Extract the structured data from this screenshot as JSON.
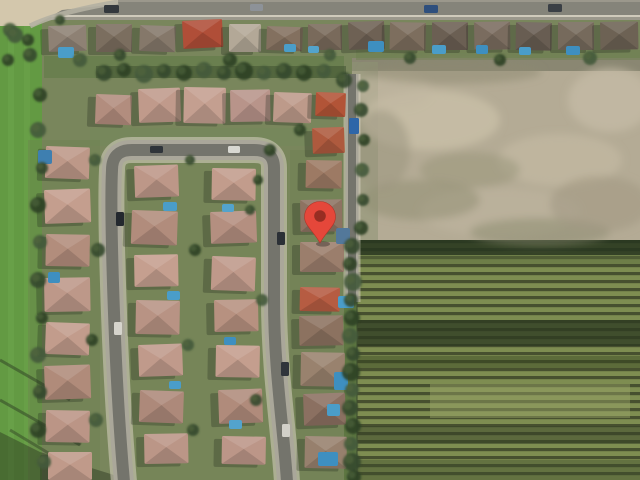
{
  "map": {
    "kind": "satellite-aerial-view",
    "width": 640,
    "height": 480,
    "marker": {
      "name": "location-pin",
      "x": 320,
      "y": 217,
      "tip_y": 243,
      "radius": 15.5,
      "color": "#e5473a",
      "inner_color": "#8e2a20",
      "inner_radius": 5.8
    },
    "palette": {
      "base": "#79865c",
      "field": "#639a43",
      "field_stripe": "#74ac52",
      "dirt": "#b4ab95",
      "crop_light": "#7e8d51",
      "crop_dark": "#47502f",
      "road_casing": "#aaa79a",
      "road_core": "#74746c",
      "sidewalk": "#d8d2c2",
      "pool": "#4a9dc9",
      "tree_colors": [
        "#34492c",
        "#2c4026",
        "#42593a"
      ]
    },
    "regions": [
      [
        0,
        0,
        640,
        20,
        "#9b988c",
        1
      ],
      [
        0,
        2,
        640,
        13,
        "#85847a",
        1
      ],
      [
        0,
        15,
        640,
        2,
        "#d5cfc0",
        0.9
      ],
      [
        0,
        18,
        42,
        462,
        "#639a43",
        1
      ],
      [
        8,
        18,
        6,
        462,
        "#74ac52",
        0.35
      ],
      [
        24,
        18,
        6,
        462,
        "#74ac52",
        0.3
      ],
      [
        352,
        58,
        288,
        184,
        "#b4ab95",
        1
      ],
      [
        352,
        58,
        288,
        13,
        "#5f6350",
        0.5
      ],
      [
        352,
        62,
        26,
        180,
        "#8e9374",
        0.55
      ],
      [
        344,
        240,
        296,
        240,
        "@crops",
        1
      ],
      [
        344,
        240,
        296,
        15,
        "#27351f",
        0.85
      ],
      [
        344,
        255,
        296,
        9,
        "#5a6d3d",
        0.45
      ],
      [
        344,
        320,
        296,
        26,
        "#2c3a22",
        0.75
      ],
      [
        344,
        356,
        296,
        12,
        "#33421f",
        0.45
      ],
      [
        430,
        384,
        200,
        34,
        "#9aa468",
        0.45
      ],
      [
        344,
        426,
        296,
        18,
        "#323f26",
        0.45
      ],
      [
        344,
        460,
        296,
        20,
        "#3c4a2b",
        0.4
      ],
      [
        344,
        240,
        13,
        240,
        "#5b7540",
        1
      ],
      [
        44,
        56,
        300,
        22,
        "#5f7a46",
        0.55
      ],
      [
        356,
        50,
        284,
        10,
        "#6b7e4d",
        0.45
      ],
      [
        90,
        128,
        220,
        18,
        "#74875a",
        0.5
      ],
      [
        28,
        140,
        72,
        340,
        "#6d8350",
        0.4
      ],
      [
        128,
        160,
        160,
        320,
        "#71864f",
        0.3
      ],
      [
        290,
        150,
        62,
        330,
        "#6a7f4c",
        0.3
      ],
      [
        96,
        66,
        250,
        12,
        "#3c4d2e",
        0.5
      ]
    ],
    "mottles": [
      [
        430,
        120,
        70,
        30,
        "#c9bfa8",
        0.8
      ],
      [
        560,
        160,
        62,
        26,
        "#c3b9a2",
        0.7
      ],
      [
        500,
        212,
        80,
        24,
        "#beb49e",
        0.6
      ],
      [
        610,
        100,
        42,
        32,
        "#c6bca6",
        0.7
      ],
      [
        392,
        92,
        40,
        18,
        "#c2b8a2",
        0.6
      ],
      [
        420,
        200,
        60,
        20,
        "#8f8d72",
        0.5
      ],
      [
        470,
        170,
        50,
        18,
        "#979478",
        0.5
      ],
      [
        540,
        232,
        70,
        14,
        "#8a8a6e",
        0.5
      ],
      [
        380,
        150,
        30,
        40,
        "#9a947e",
        0.5
      ],
      [
        600,
        204,
        50,
        28,
        "#a39a84",
        0.6
      ],
      [
        452,
        72,
        90,
        12,
        "#8d8a70",
        0.5
      ]
    ],
    "polys": [
      [
        "0,0 118,0 118,4 62,10 34,26 0,26",
        "#d3c7ac",
        1
      ],
      [
        "0,432 40,452 130,480 0,480",
        "#2a3520",
        0.45
      ]
    ],
    "paths": [
      [
        "M118,2 Q58,12 30,26",
        "#b4b0a2",
        5,
        0.9
      ],
      [
        "M0,360 L70,400",
        "#2e3d24",
        3,
        0.5
      ],
      [
        "M0,400 L80,445",
        "#2e3d24",
        3,
        0.5
      ],
      [
        "M10,430 L90,478",
        "#2e3d24",
        3,
        0.45
      ],
      [
        "M357,240 L357,480",
        "#3f4f30",
        1.5,
        0.7
      ]
    ],
    "roads": [
      [
        "M124,482 C114,370 110,210 112,170 Q112,150 132,150 L254,150 Q274,150 274,168 L274,300 C274,370 284,432 287,482",
        26,
        20,
        12
      ],
      [
        "M352,74 L352,302",
        17,
        13,
        8
      ]
    ],
    "houses": [
      [
        48,
        26,
        38,
        26,
        -2,
        "#8e8174"
      ],
      [
        96,
        24,
        36,
        28,
        0,
        "#7b6e5f"
      ],
      [
        140,
        25,
        36,
        26,
        2,
        "#85786a"
      ],
      [
        182,
        21,
        40,
        28,
        -3,
        "#b04e38"
      ],
      [
        229,
        24,
        32,
        28,
        0,
        "#b3a897"
      ],
      [
        267,
        26,
        36,
        24,
        2,
        "#83705f"
      ],
      [
        308,
        24,
        34,
        26,
        0,
        "#796a5b"
      ],
      [
        348,
        22,
        36,
        28,
        -2,
        "#6e6154"
      ],
      [
        390,
        22,
        36,
        28,
        1,
        "#7d6e5e"
      ],
      [
        432,
        22,
        36,
        28,
        0,
        "#6b5f53"
      ],
      [
        474,
        22,
        36,
        28,
        -1,
        "#7a6c5f"
      ],
      [
        516,
        22,
        36,
        28,
        1,
        "#685d52"
      ],
      [
        558,
        22,
        36,
        28,
        0,
        "#766a5c"
      ],
      [
        600,
        22,
        38,
        28,
        -1,
        "#6d6254"
      ],
      [
        96,
        94,
        36,
        30,
        2,
        "#b28d7e"
      ],
      [
        138,
        89,
        42,
        34,
        -2,
        "#c09a8b"
      ],
      [
        184,
        87,
        42,
        36,
        1,
        "#c49f90"
      ],
      [
        230,
        90,
        40,
        32,
        -1,
        "#b8948a"
      ],
      [
        274,
        92,
        38,
        30,
        2,
        "#bd9a8a"
      ],
      [
        46,
        146,
        44,
        32,
        2,
        "#bd9888"
      ],
      [
        44,
        190,
        46,
        34,
        -2,
        "#c49e8e"
      ],
      [
        46,
        234,
        44,
        32,
        1,
        "#b28d7c"
      ],
      [
        44,
        278,
        46,
        34,
        -1,
        "#bd9889"
      ],
      [
        46,
        322,
        44,
        32,
        2,
        "#c29c8c"
      ],
      [
        44,
        366,
        46,
        34,
        -2,
        "#b08b7a"
      ],
      [
        46,
        410,
        44,
        32,
        1,
        "#bb9586"
      ],
      [
        48,
        452,
        44,
        28,
        0,
        "#c09a8a"
      ],
      [
        134,
        166,
        44,
        32,
        -2,
        "#bd9788"
      ],
      [
        132,
        210,
        46,
        34,
        2,
        "#b18c7c"
      ],
      [
        134,
        255,
        44,
        32,
        -1,
        "#c59f8f"
      ],
      [
        136,
        300,
        44,
        34,
        1,
        "#b89384"
      ],
      [
        138,
        345,
        44,
        32,
        -2,
        "#c09a8b"
      ],
      [
        140,
        390,
        44,
        32,
        2,
        "#ad897a"
      ],
      [
        144,
        434,
        44,
        30,
        -1,
        "#bb9687"
      ],
      [
        212,
        168,
        44,
        32,
        1,
        "#c29c8c"
      ],
      [
        210,
        212,
        46,
        32,
        -2,
        "#b48f80"
      ],
      [
        212,
        256,
        44,
        34,
        2,
        "#bf998a"
      ],
      [
        214,
        300,
        44,
        32,
        -1,
        "#b79180"
      ],
      [
        216,
        345,
        44,
        32,
        1,
        "#c49e8e"
      ],
      [
        218,
        390,
        44,
        34,
        -2,
        "#b08b7b"
      ],
      [
        222,
        436,
        44,
        28,
        1,
        "#bc9688"
      ],
      [
        316,
        92,
        30,
        24,
        2,
        "#b25437"
      ],
      [
        312,
        128,
        32,
        26,
        -2,
        "#ae5a3e"
      ],
      [
        306,
        160,
        36,
        28,
        1,
        "#9d7a64"
      ],
      [
        300,
        200,
        42,
        32,
        -1,
        "#8d7362"
      ],
      [
        300,
        242,
        44,
        30,
        0,
        "#9b7e6c"
      ],
      [
        300,
        287,
        40,
        24,
        1,
        "#b65c42"
      ],
      [
        299,
        316,
        44,
        30,
        -1,
        "#8c7260"
      ],
      [
        301,
        352,
        44,
        34,
        1,
        "#99826e"
      ],
      [
        303,
        394,
        42,
        32,
        -2,
        "#8b7061"
      ],
      [
        305,
        436,
        42,
        32,
        1,
        "#97806d"
      ]
    ],
    "pools": [
      [
        58,
        47,
        16,
        11,
        "#4a9dc9"
      ],
      [
        284,
        44,
        12,
        8,
        "#4a9dc9"
      ],
      [
        308,
        46,
        11,
        7,
        "#53a3cc"
      ],
      [
        368,
        41,
        16,
        11,
        "#3e8fc0"
      ],
      [
        432,
        45,
        14,
        9,
        "#4a9dc9"
      ],
      [
        476,
        45,
        12,
        9,
        "#3e8fc0"
      ],
      [
        519,
        47,
        12,
        8,
        "#4a9dc9"
      ],
      [
        566,
        46,
        14,
        9,
        "#3e8fc0"
      ],
      [
        163,
        202,
        14,
        9,
        "#4a9dc9"
      ],
      [
        222,
        204,
        12,
        8,
        "#53a3cc"
      ],
      [
        167,
        291,
        13,
        9,
        "#4a9dc9"
      ],
      [
        224,
        337,
        12,
        8,
        "#3e8fc0"
      ],
      [
        169,
        381,
        12,
        8,
        "#4a9dc9"
      ],
      [
        229,
        420,
        13,
        9,
        "#53a3cc"
      ],
      [
        48,
        272,
        12,
        11,
        "#3e8fc0"
      ],
      [
        38,
        150,
        14,
        14,
        "#3e7fb0"
      ],
      [
        336,
        228,
        14,
        16,
        "#53789a"
      ],
      [
        338,
        296,
        16,
        12,
        "#4a9dc9"
      ],
      [
        334,
        372,
        14,
        18,
        "#3e8fc0"
      ],
      [
        327,
        404,
        13,
        12,
        "#4a9dc9"
      ],
      [
        318,
        452,
        20,
        14,
        "#3e8fc0"
      ]
    ],
    "cars": [
      [
        104,
        5,
        15,
        8,
        "#33383d"
      ],
      [
        250,
        4,
        13,
        7,
        "#8d9298"
      ],
      [
        424,
        5,
        14,
        8,
        "#2e4f7d"
      ],
      [
        548,
        4,
        14,
        8,
        "#3a3f45"
      ],
      [
        150,
        146,
        13,
        7,
        "#2f343a"
      ],
      [
        228,
        146,
        12,
        7,
        "#d8d8d2"
      ],
      [
        116,
        212,
        8,
        14,
        "#23282e"
      ],
      [
        114,
        322,
        8,
        13,
        "#d6d4cc"
      ],
      [
        277,
        232,
        8,
        13,
        "#2b3036"
      ],
      [
        281,
        362,
        8,
        14,
        "#30353b"
      ],
      [
        282,
        424,
        8,
        13,
        "#d2d0c8"
      ],
      [
        349,
        118,
        10,
        16,
        "#2e66a8"
      ]
    ],
    "trees": [
      [
        104,
        73,
        8
      ],
      [
        124,
        70,
        7
      ],
      [
        144,
        74,
        9
      ],
      [
        164,
        71,
        7
      ],
      [
        184,
        73,
        8
      ],
      [
        204,
        70,
        8
      ],
      [
        224,
        73,
        7
      ],
      [
        244,
        71,
        9
      ],
      [
        264,
        73,
        7
      ],
      [
        284,
        71,
        8
      ],
      [
        304,
        73,
        8
      ],
      [
        324,
        71,
        7
      ],
      [
        344,
        80,
        8
      ],
      [
        40,
        95,
        7
      ],
      [
        38,
        130,
        8
      ],
      [
        42,
        168,
        6
      ],
      [
        38,
        205,
        8
      ],
      [
        40,
        242,
        7
      ],
      [
        38,
        280,
        8
      ],
      [
        42,
        318,
        6
      ],
      [
        38,
        355,
        8
      ],
      [
        40,
        392,
        7
      ],
      [
        38,
        430,
        8
      ],
      [
        44,
        462,
        7
      ],
      [
        352,
        246,
        8
      ],
      [
        350,
        264,
        7
      ],
      [
        353,
        282,
        9
      ],
      [
        351,
        300,
        7
      ],
      [
        352,
        318,
        8
      ],
      [
        350,
        336,
        8
      ],
      [
        353,
        354,
        7
      ],
      [
        351,
        372,
        9
      ],
      [
        352,
        390,
        7
      ],
      [
        350,
        408,
        8
      ],
      [
        353,
        426,
        8
      ],
      [
        351,
        444,
        7
      ],
      [
        352,
        462,
        9
      ],
      [
        354,
        477,
        7
      ],
      [
        363,
        86,
        6
      ],
      [
        361,
        110,
        7
      ],
      [
        364,
        140,
        6
      ],
      [
        362,
        170,
        7
      ],
      [
        363,
        200,
        6
      ],
      [
        361,
        228,
        7
      ],
      [
        95,
        160,
        6
      ],
      [
        98,
        250,
        7
      ],
      [
        92,
        340,
        6
      ],
      [
        96,
        420,
        7
      ],
      [
        190,
        160,
        5
      ],
      [
        195,
        250,
        6
      ],
      [
        188,
        345,
        6
      ],
      [
        193,
        430,
        6
      ],
      [
        258,
        180,
        5
      ],
      [
        262,
        300,
        6
      ],
      [
        256,
        400,
        6
      ],
      [
        300,
        130,
        6
      ],
      [
        80,
        60,
        7
      ],
      [
        120,
        55,
        6
      ],
      [
        230,
        60,
        7
      ],
      [
        330,
        55,
        6
      ],
      [
        410,
        58,
        6
      ],
      [
        500,
        60,
        6
      ],
      [
        590,
        58,
        7
      ],
      [
        60,
        20,
        5
      ],
      [
        28,
        40,
        6
      ],
      [
        10,
        30,
        7
      ],
      [
        250,
        210,
        5
      ],
      [
        270,
        150,
        6
      ],
      [
        15,
        35,
        8
      ],
      [
        30,
        55,
        7
      ],
      [
        8,
        60,
        6
      ]
    ]
  }
}
